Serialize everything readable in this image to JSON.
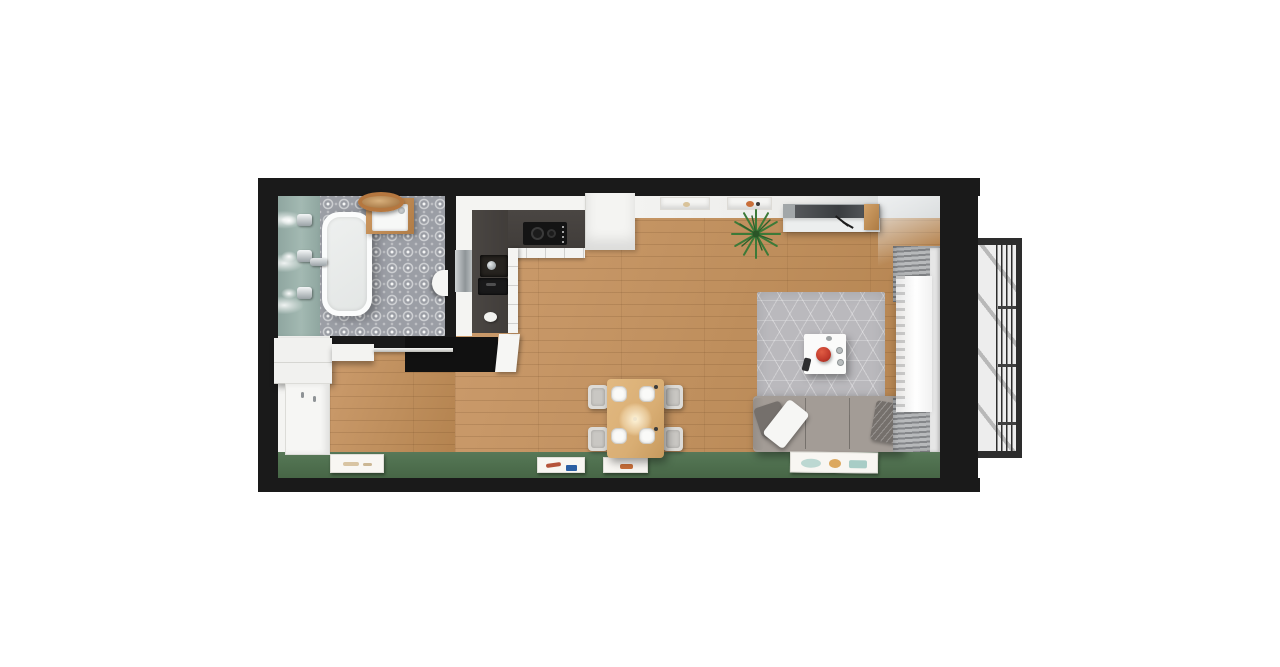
{
  "palette": {
    "wall": "#1a1a1a",
    "wood": "#bf8f5d",
    "wood-light": "#cc9c6d",
    "wood-dark": "#b4834f",
    "green": "#507150",
    "green-dark": "#476646",
    "teal": "#a3b9b2",
    "teal-dark": "#8fa6a0",
    "tile": "#9b9ea5",
    "white": "#f4f4f2",
    "door-white": "#f6f6f4",
    "counter": "#413d3a",
    "cooktop": "#141414",
    "rug": "#bab9bd",
    "sofa": "#a39c96",
    "pillow-dark": "#75706c",
    "table-wood": "#d9ae74",
    "red": "#c0392b",
    "metal": "#2d2d2d",
    "panel": "#ededed",
    "tv-base": "#a2a7a9",
    "plant-green": "#3c7a38"
  },
  "scene": {
    "type": "apartment-floor-plan-3d-top-view",
    "rooms": [
      {
        "name": "bathroom",
        "objects": [
          "bathtub",
          "tub-faucet",
          "vanity-sink",
          "round-mirror",
          "wall-sconces",
          "patterned-tile-floor",
          "teal-accent-wall",
          "open-door-leaf"
        ]
      },
      {
        "name": "kitchen",
        "objects": [
          "l-shaped-dark-countertop",
          "white-cabinets",
          "cooktop",
          "kitchen-sink",
          "built-in-appliance",
          "tall-cabinet",
          "metal-panel",
          "white-bowl"
        ]
      },
      {
        "name": "hallway",
        "objects": [
          "wardrobe",
          "hall-shelf",
          "coat-rail",
          "entrance-door",
          "open-interior-door",
          "partition-wall"
        ]
      },
      {
        "name": "living-dining-room",
        "objects": [
          "wood-plank-floor",
          "dining-table",
          "dining-chairs-x4",
          "plates-x4",
          "sofa",
          "throw-pillows",
          "area-rug",
          "coffee-table",
          "red-bowl",
          "remote-control",
          "tv-console",
          "wall-shelves-x2",
          "potted-plant",
          "gray-curtains",
          "sheer-curtain",
          "green-accent-wall",
          "picture-frames-x4"
        ]
      },
      {
        "name": "french-balcony",
        "objects": [
          "metal-bar-railing"
        ]
      }
    ]
  }
}
